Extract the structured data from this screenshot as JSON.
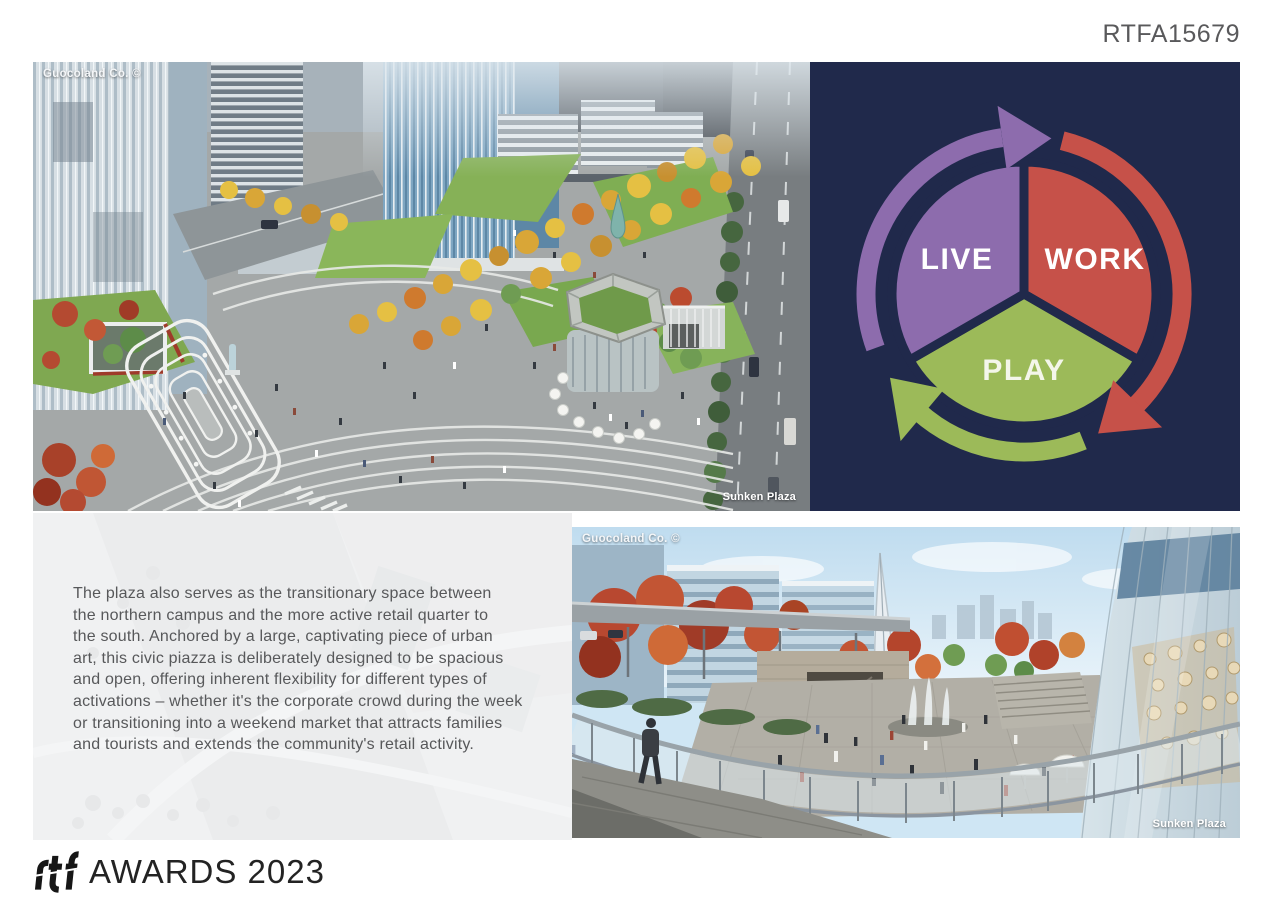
{
  "page": {
    "ref_code": "RTFA15679",
    "footer_brand": "rtf",
    "footer_text": "AWARDS 2023"
  },
  "top_image": {
    "credit": "Guocoland Co. ©",
    "caption": "Sunken Plaza"
  },
  "diagram": {
    "background": "#20294b",
    "segments": [
      {
        "label": "LIVE",
        "color": "#8d6cad"
      },
      {
        "label": "WORK",
        "color": "#c65149"
      },
      {
        "label": "PLAY",
        "color": "#9cba59"
      }
    ]
  },
  "description": "The plaza also serves as the transitionary space between\nthe northern campus and the more active retail quarter to\nthe south. Anchored by a large, captivating piece of urban\nart, this civic piazza is deliberately designed to be spacious\nand open, offering inherent flexibility for different types of\nactivations – whether it's the corporate crowd during the week\nor transitioning into a weekend market that attracts families\nand tourists and extends the community's retail activity.",
  "bottom_image": {
    "credit": "Guocoland Co. ©",
    "caption": "Sunken Plaza"
  }
}
